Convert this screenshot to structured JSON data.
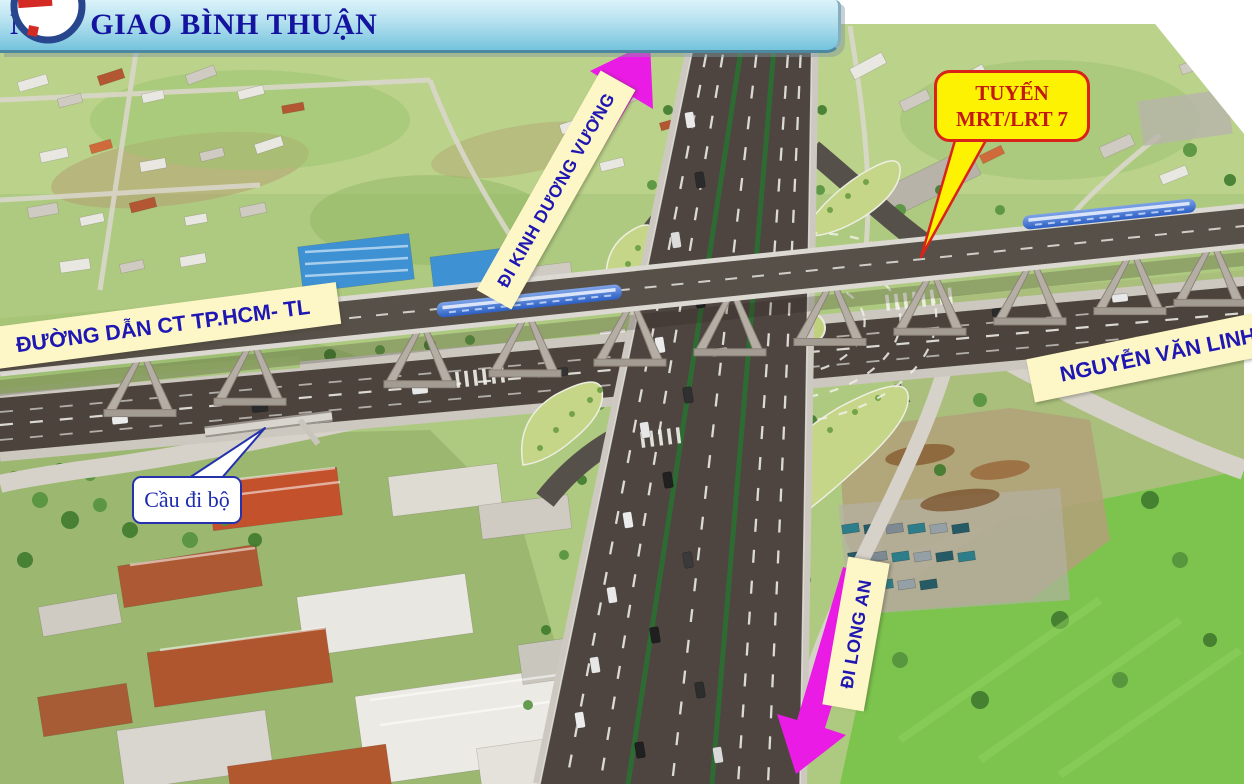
{
  "slide": {
    "title": "NÚT  GIAO BÌNH THUẬN",
    "labels": {
      "di_kinh_duong_vuong": "ĐI KINH DƯƠNG VƯƠNG",
      "tuyen_mrt_line1": "TUYẾN",
      "tuyen_mrt_line2": "MRT/LRT 7",
      "duong_dan_ct": "ĐƯỜNG DẪN CT TP.HCM- TL",
      "nguyen_van_linh": "NGUYỄN VĂN LINH",
      "cau_di_bo": "Cầu đi bộ",
      "di_long_an": "ĐI LONG AN"
    },
    "colors": {
      "title_blue": "#1414a0",
      "label_blue": "#1e17b4",
      "label_cream": "#fdf6c6",
      "arrow_magenta": "#ea1be4",
      "callout_yellow": "#fdf202",
      "callout_red": "#da2318",
      "titlebar_blue": "#74c3dd"
    },
    "icons": [
      "up-right-arrow-icon",
      "down-left-arrow-icon",
      "callout-pointer-icon",
      "circle-logo-icon"
    ]
  }
}
